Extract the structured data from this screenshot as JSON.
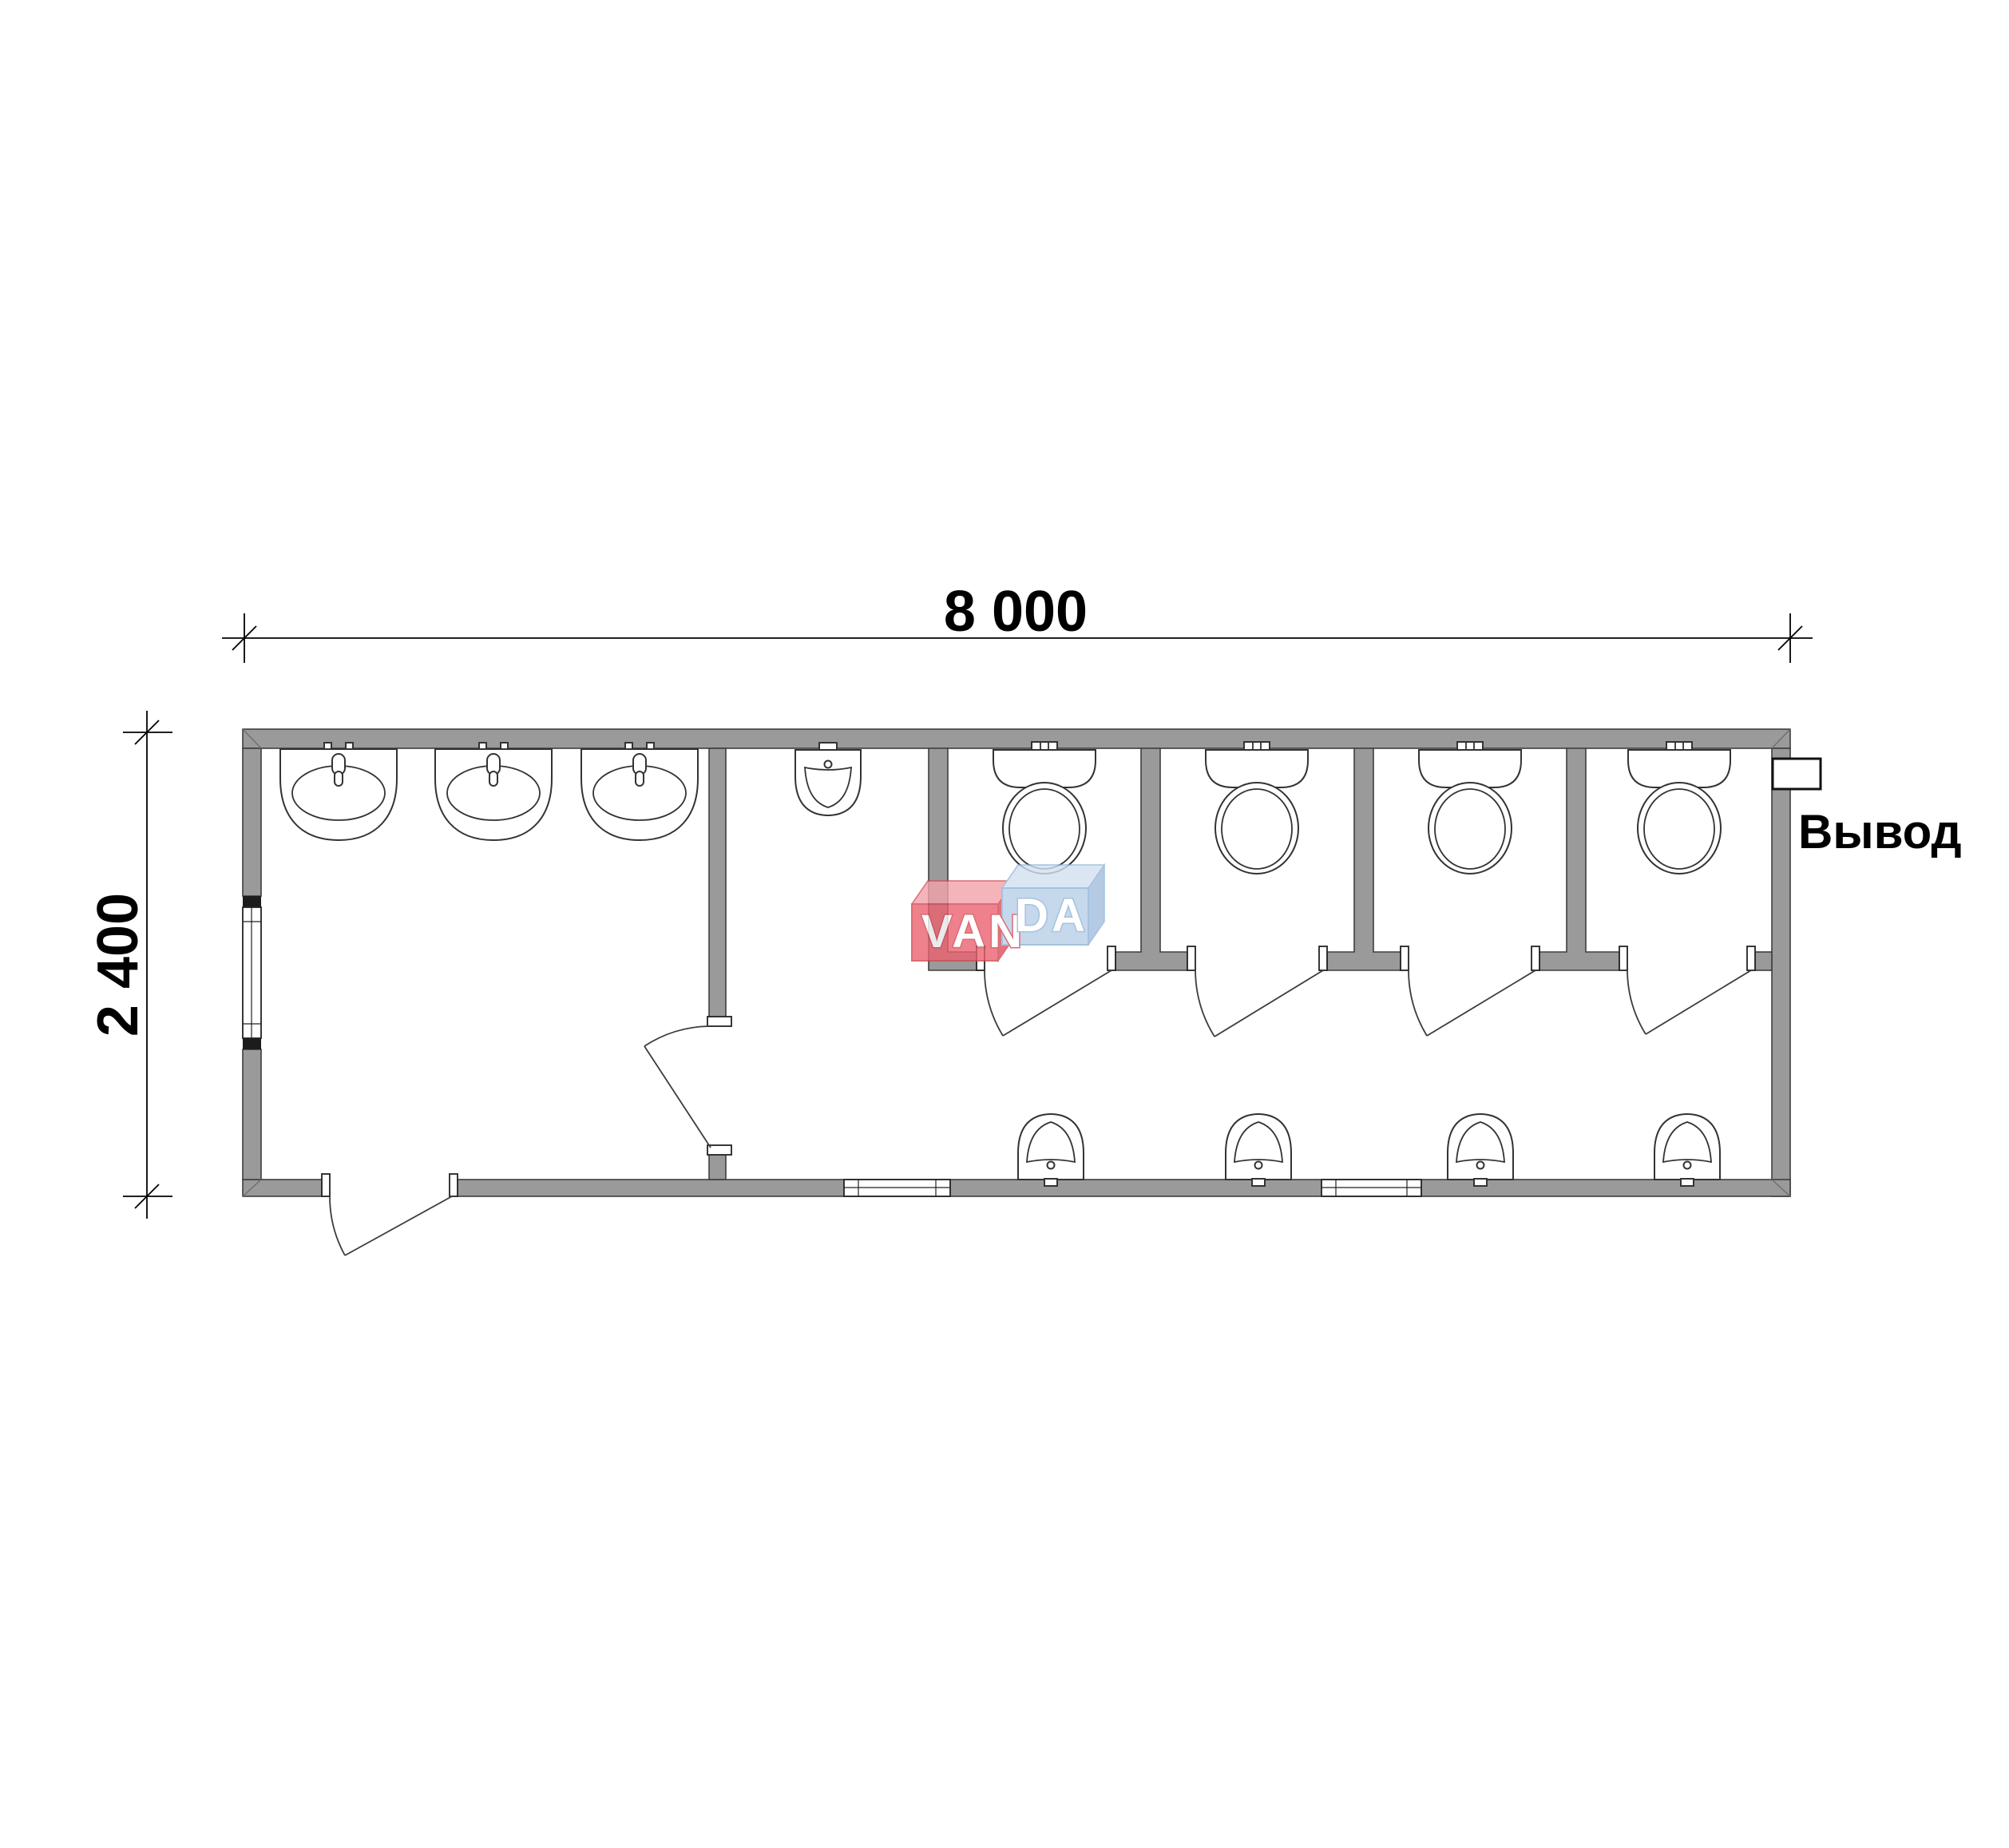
{
  "dimensions": {
    "width_label": "8 000",
    "height_label": "2 400"
  },
  "annotations": {
    "outlet_label": "Вывод"
  },
  "watermark": {
    "brand": "VANDA",
    "text_left": "VAN",
    "text_right": "DA",
    "red_front": "#ec6270",
    "red_top": "#f3a2aa",
    "red_side": "#d9505e",
    "red_outline": "#d34753",
    "blue_front": "#b9cfe8",
    "blue_top": "#d3e1f2",
    "blue_side": "#a3bedd",
    "blue_outline": "#8fb3d8"
  },
  "colors": {
    "wall_fill": "#9a9a9a",
    "outline": "#3f3f3f",
    "dimension": "#000000",
    "background": "#ffffff"
  },
  "plan": {
    "type": "sanitary-module-floor-plan",
    "rooms": [
      {
        "name": "washroom",
        "fixtures": [
          "washbasin",
          "washbasin",
          "washbasin"
        ]
      },
      {
        "name": "corridor",
        "fixtures": [
          "urinal",
          "wall-urinal",
          "wall-urinal",
          "wall-urinal",
          "wall-urinal"
        ]
      },
      {
        "name": "wc-stall-1",
        "fixtures": [
          "toilet"
        ]
      },
      {
        "name": "wc-stall-2",
        "fixtures": [
          "toilet"
        ]
      },
      {
        "name": "wc-stall-3",
        "fixtures": [
          "toilet"
        ]
      },
      {
        "name": "wc-stall-4",
        "fixtures": [
          "toilet"
        ]
      }
    ],
    "openings": [
      "entrance-door",
      "interior-door",
      "stall-door",
      "stall-door",
      "stall-door",
      "stall-door",
      "window-left-wall",
      "window-bottom-1",
      "window-bottom-2"
    ],
    "utility": [
      "outlet-stub"
    ]
  }
}
